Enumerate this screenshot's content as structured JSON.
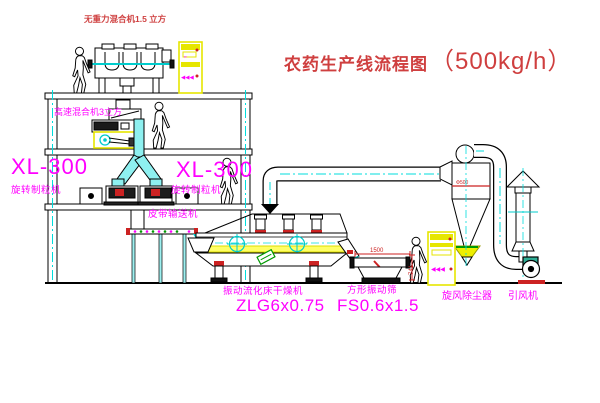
{
  "title": {
    "text": "农药生产线流程图",
    "capacity": "（500kg/h）"
  },
  "colors": {
    "label_magenta": "#ff00ff",
    "title_red": "#cf3f3f",
    "line_cyan": "#00dddd",
    "cabinet_yellow": "#e6e600",
    "accent_red": "#cc2222",
    "dryer_strip_yellow": "#ffff66",
    "motor_teal": "#2fae96"
  },
  "equipment": {
    "gravity_mixer": {
      "label": "无重力混合机1.5 立方"
    },
    "highspeed_mixer": {
      "label": "高速混合机3立方"
    },
    "granulator_left": {
      "model": "XL-300",
      "name": "旋转制粒机"
    },
    "granulator_right": {
      "model": "XL-300",
      "name": "旋转制粒机"
    },
    "belt_conveyor": {
      "label": "皮带输送机"
    },
    "fluid_bed_dryer": {
      "label": "振动流化床干燥机",
      "model": "ZLG6x0.75"
    },
    "square_sieve": {
      "label": "方形振动筛",
      "model": "FS0.6x1.5",
      "dim_width": "1500",
      "dim_height": "741"
    },
    "cyclone": {
      "label": "旋风除尘器",
      "marking": "Φ500"
    },
    "fan": {
      "label": "引风机"
    }
  },
  "cabinets": {
    "glyph": "◀◀◀",
    "mini_glyph": "▪▪"
  }
}
